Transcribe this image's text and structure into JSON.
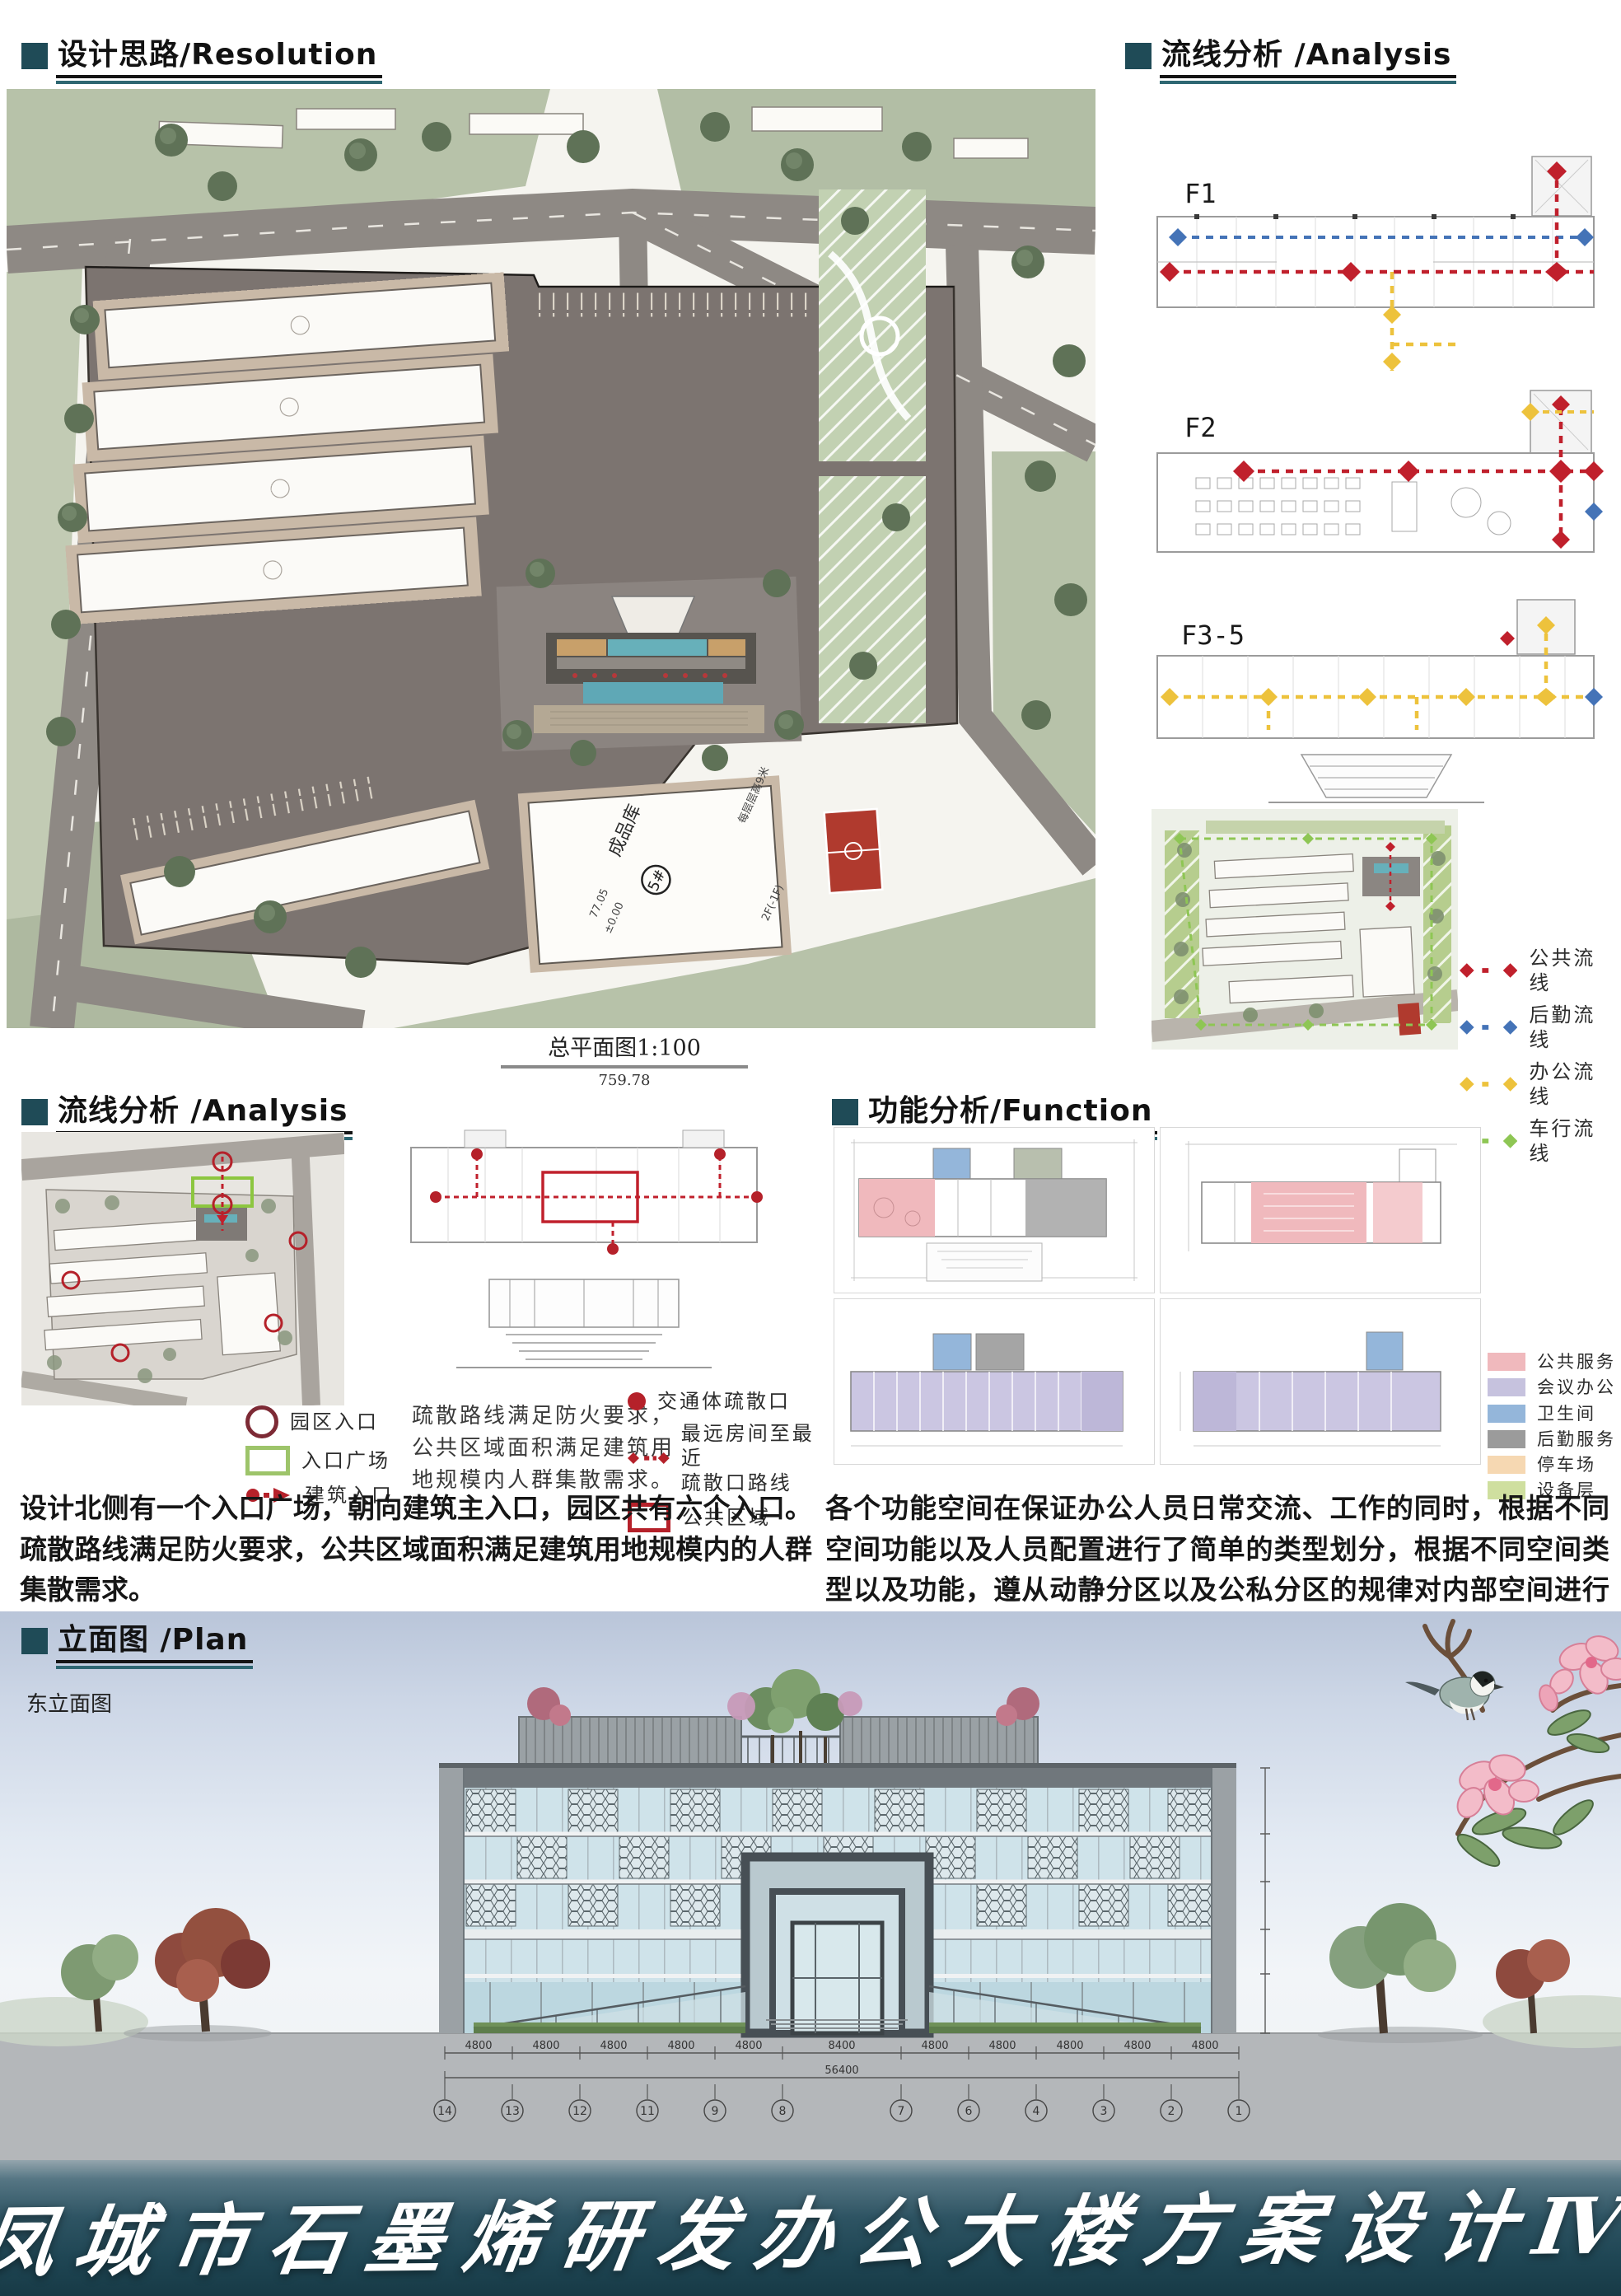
{
  "headers": {
    "resolution": "设计思路/Resolution",
    "analysis_top": "流线分析 /Analysis",
    "analysis_mid": "流线分析 /Analysis",
    "function": "功能分析/Function",
    "plan": "立面图 /Plan"
  },
  "colors": {
    "header_square": "#1f4b57",
    "underline_black": "#141414",
    "underline_teal": "#2e6772",
    "flow_public": "#c0202c",
    "flow_logistics": "#4473b7",
    "flow_office": "#edc23c",
    "flow_vehicle": "#8ec654",
    "footer_teal_dark": "#173a46"
  },
  "master_plan": {
    "caption": "总平面图1:100",
    "width_dim": "759.78",
    "b5_name": "成品库",
    "b5_no": "5#",
    "b5_elev": "77.05",
    "b5_zero": "±0.00",
    "b5_floor_note": "每层层高9米",
    "b5_storeys": "2F(-1F)"
  },
  "circulation": {
    "f1": "F1",
    "f2": "F2",
    "f35": "F3-5",
    "legend": [
      {
        "label": "公共流线",
        "color": "#c0202c"
      },
      {
        "label": "后勤流线",
        "color": "#4473b7"
      },
      {
        "label": "办公流线",
        "color": "#edc23c"
      },
      {
        "label": "车行流线",
        "color": "#8ec654"
      }
    ]
  },
  "flow": {
    "entrance_legend": [
      {
        "label": "园区入口"
      },
      {
        "label": "入口广场"
      },
      {
        "label": "建筑入口"
      }
    ],
    "evac_note": "疏散路线满足防火要求，\n公共区域面积满足建筑用\n地规模内人群集散需求。",
    "evac_legend": [
      {
        "label": "交通体疏散口"
      },
      {
        "label": "最远房间至最近\n疏散口路线"
      },
      {
        "label": "公共区域"
      }
    ],
    "paragraph": "设计北侧有一个入口广场，朝向建筑主入口，园区共有六个入口。疏散路线满足防火要求，公共区域面积满足建筑用地规模内的人群集散需求。"
  },
  "func": {
    "legend": [
      {
        "label": "公共服务",
        "color": "#f0b9bd"
      },
      {
        "label": "会议办公",
        "color": "#c6c2de"
      },
      {
        "label": "卫生间",
        "color": "#94b6da"
      },
      {
        "label": "后勤服务",
        "color": "#9b9b9b"
      },
      {
        "label": "停车场",
        "color": "#f6d8b2"
      },
      {
        "label": "设备层",
        "color": "#cfdf9f"
      }
    ],
    "paragraph": "各个功能空间在保证办公人员日常交流、工作的同时，根据不同空间功能以及人员配置进行了简单的类型划分，根据不同空间类型以及功能，遵从动静分区以及公私分区的规律对内部空间进行了设计。"
  },
  "elevation": {
    "label": "东立面图",
    "grid_numbers": [
      "14",
      "13",
      "12",
      "11",
      "9",
      "8",
      "7",
      "6",
      "4",
      "3",
      "2",
      "1"
    ],
    "span_dims": [
      "4800",
      "4800",
      "4800",
      "4800",
      "4800",
      "8400",
      "4800",
      "4800",
      "4800",
      "4800",
      "4800"
    ],
    "total_dim": "56400"
  },
  "footer": {
    "title": "凤城市石墨烯研发办公大楼方案设计Ⅳ"
  }
}
